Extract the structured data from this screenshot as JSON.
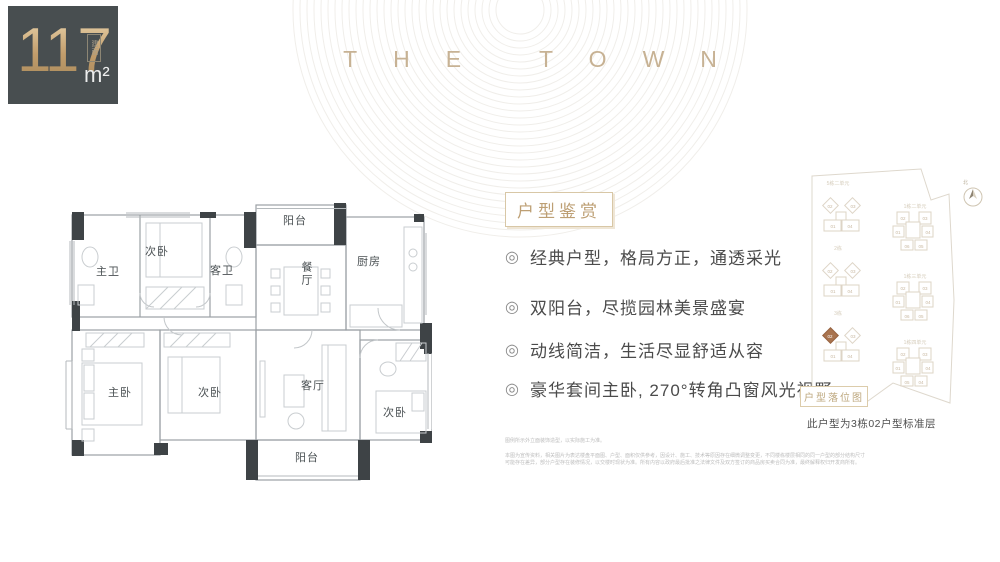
{
  "badge": {
    "value": "117",
    "prefix": "建面",
    "unit": "m²"
  },
  "brand": {
    "title": "THE TOWN"
  },
  "floorplan": {
    "labels": {
      "balcony_top": "阳台",
      "bedroom_top": "次卧",
      "bath_master": "主卫",
      "bath_guest": "客卫",
      "dining": "餐厅",
      "kitchen": "厨房",
      "bedroom_master": "主卧",
      "bedroom_mid": "次卧",
      "living": "客厅",
      "bedroom_right": "次卧",
      "balcony_bottom": "阳台"
    }
  },
  "features": {
    "heading": "户型鉴赏",
    "bullet_symbol": "◎",
    "items": [
      "经典户型，格局方正，通透采光",
      "双阳台，尽揽园林美景盛宴",
      "动线简洁，生活尽显舒适从容",
      "豪华套间主卧, 270°转角凸窗风光视野"
    ]
  },
  "siteplan": {
    "caption": "户型落位图",
    "note": "此户型为3栋02户型标准层",
    "north": "北",
    "left_buildings": [
      {
        "label": "5栋二单元",
        "u02": "02",
        "u03": "03",
        "u01": "01",
        "u04": "04"
      },
      {
        "label": "2栋",
        "u02": "02",
        "u03": "03",
        "u01": "01",
        "u04": "04"
      },
      {
        "label": "3栋",
        "u02": "02",
        "u03": "03",
        "u01": "01",
        "u04": "04"
      }
    ],
    "right_buildings": [
      {
        "label": "1栋二单元",
        "u02": "02",
        "u03": "03",
        "u01": "01",
        "u04": "04",
        "u06": "06",
        "u05": "05"
      },
      {
        "label": "1栋三单元",
        "u02": "02",
        "u03": "03",
        "u01": "01",
        "u04": "04",
        "u06": "06",
        "u05": "05"
      },
      {
        "label": "1栋四单元",
        "u02": "02",
        "u03": "03",
        "u01": "01",
        "u04": "04",
        "u06": "05",
        "u05": "04"
      }
    ]
  },
  "disclaimer": {
    "line1": "图例所示外立面装饰造型，以实际施工为准。",
    "para": "本图为宣传资料，相关图片为表达楼盘平面图、户型、面积仅供参考，因设计、施工、技术等原因存在细微调整变更，不同楼栋楼层相同的同一户型的部分结构尺寸可能存在差异，部分户型存在装修情况，以交楼时现状为准。所有内容以政府最后批准之法律文件及双方签订的商品房买卖合同为准，最终解释权归开发商所有。"
  },
  "colors": {
    "badge_bg": "#484e50",
    "gold": "#c9a878",
    "brand_gold": "#c7b294",
    "heading_tan": "#bd9f74",
    "body_text": "#4b4b4b",
    "wall_dark": "#3e4346",
    "highlight_unit": "#a9744f"
  }
}
